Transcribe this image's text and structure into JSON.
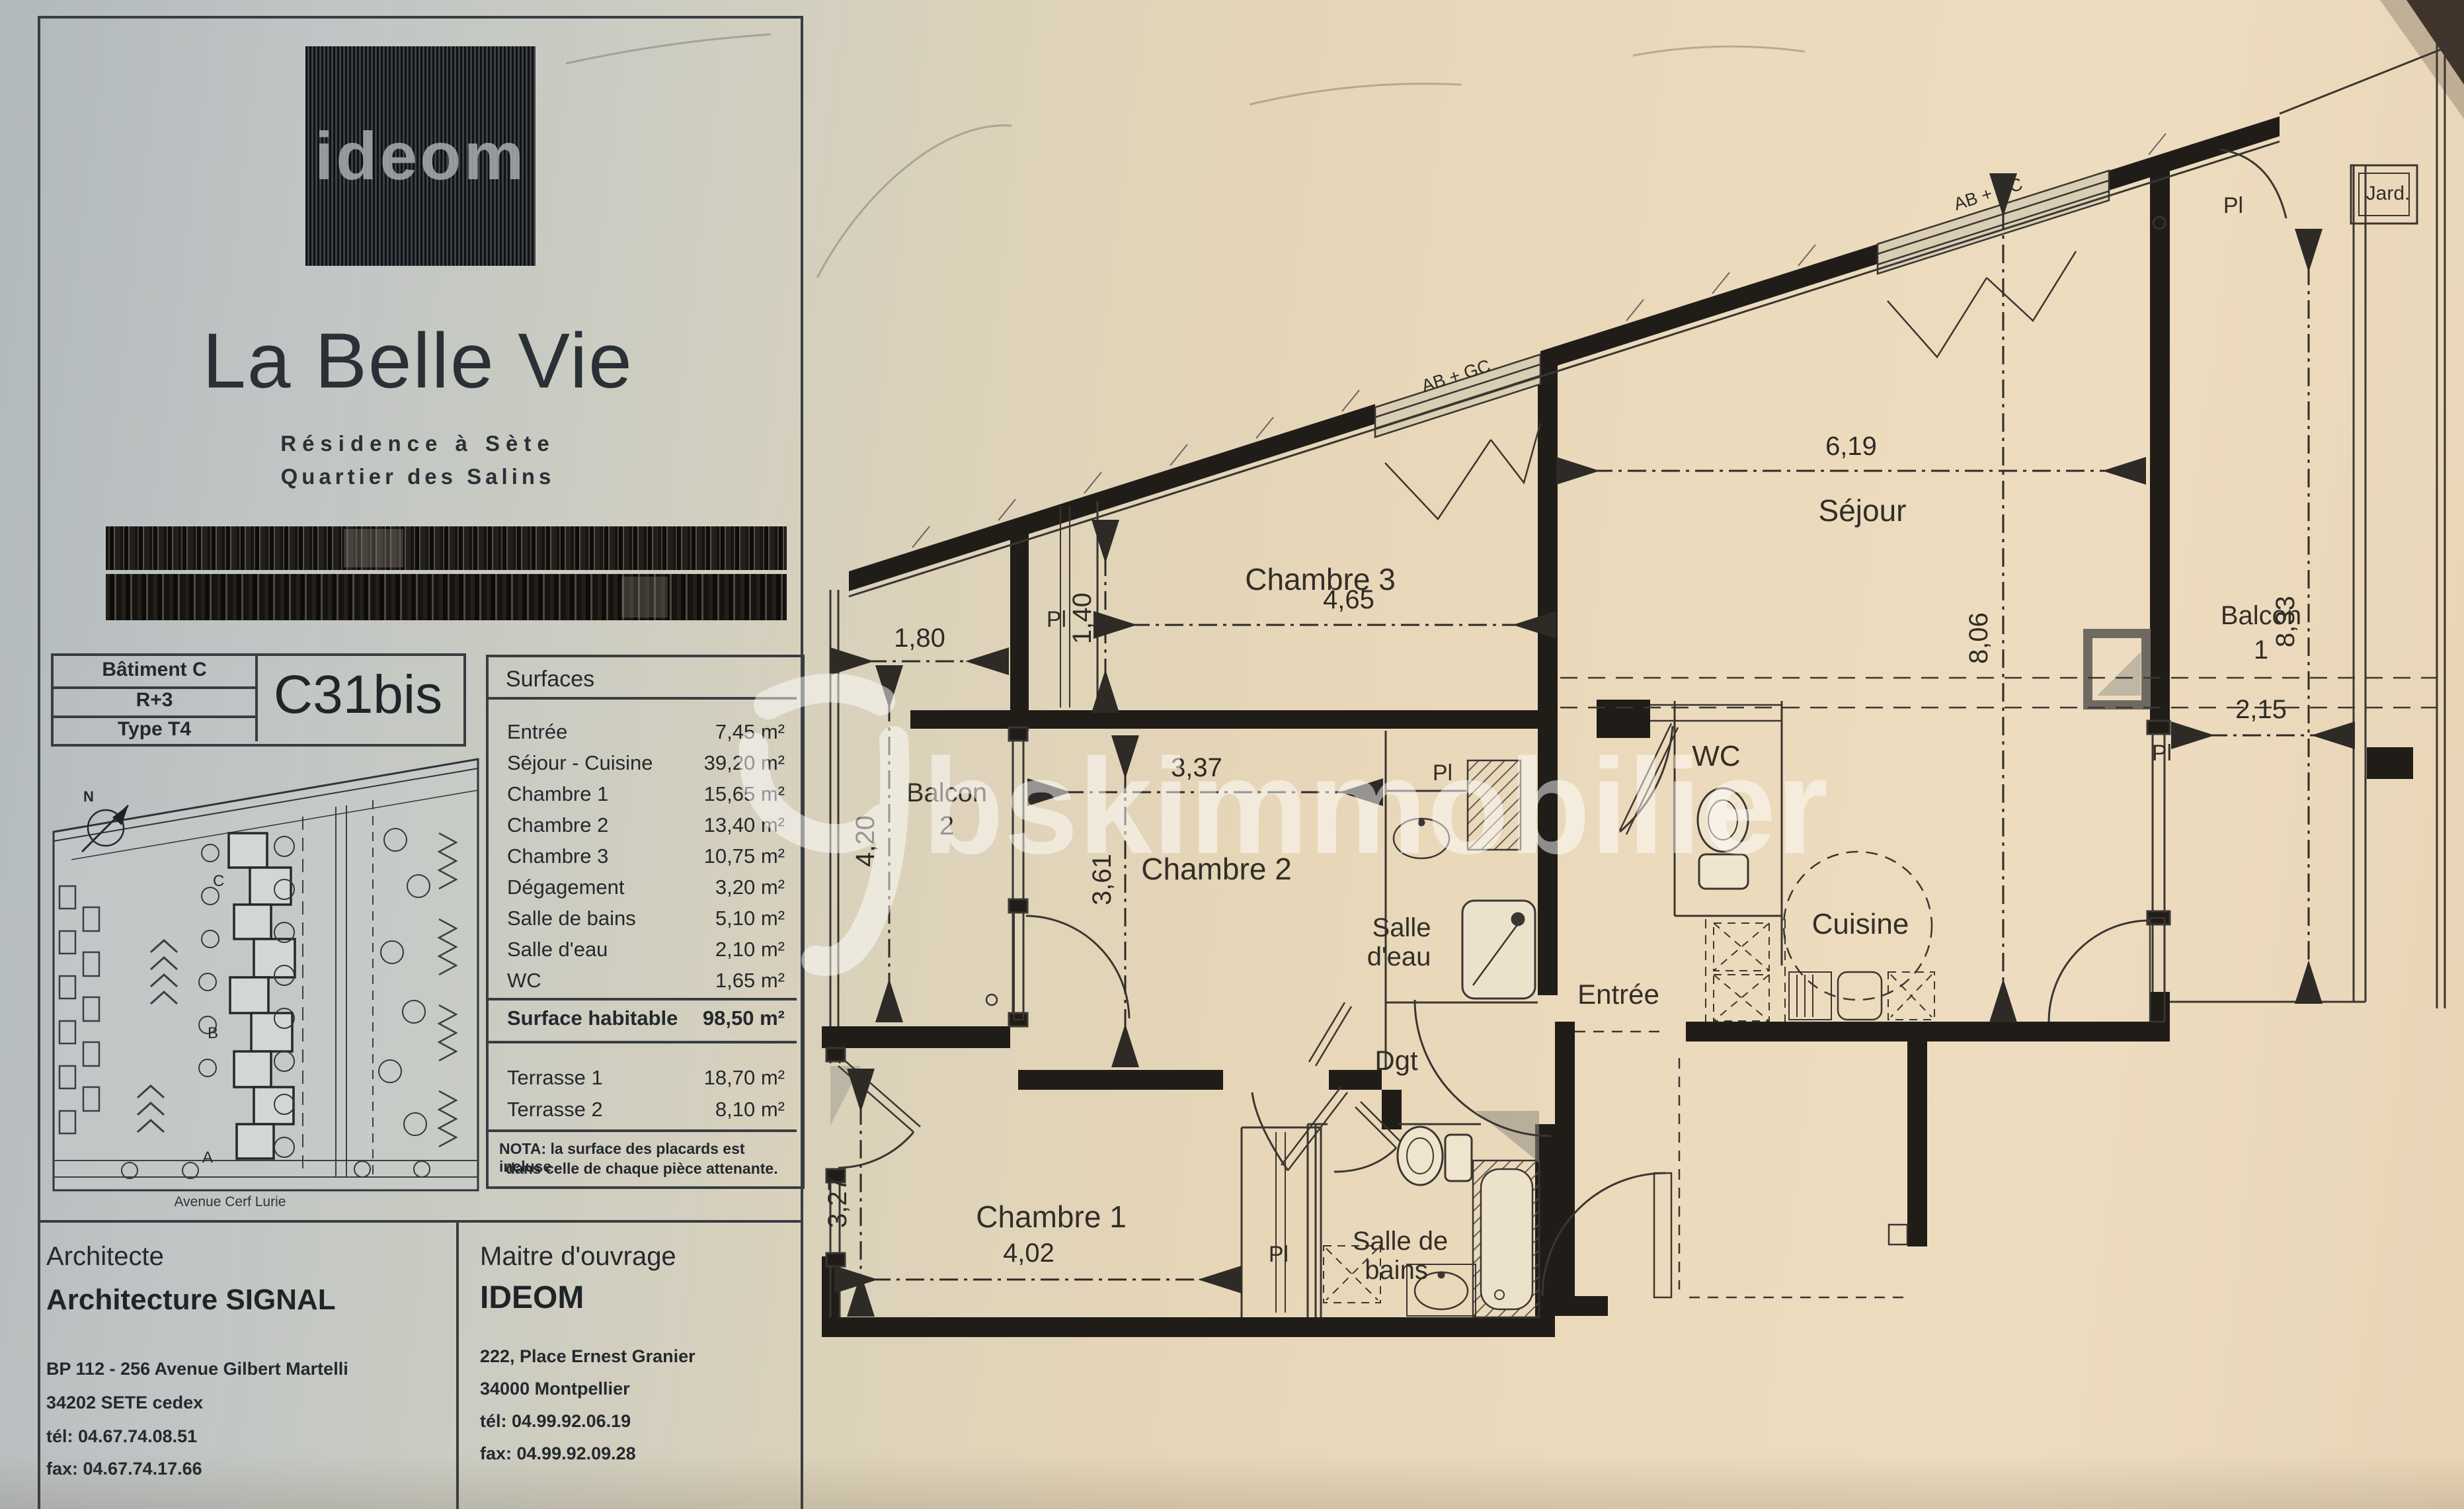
{
  "document": {
    "logo": "ideom",
    "title": "La Belle Vie",
    "subtitle1": "Résidence à Sète",
    "subtitle2": "Quartier des Salins"
  },
  "building": {
    "batiment": "Bâtiment C",
    "etage": "R+3",
    "type": "Type T4",
    "lot": "C31bis"
  },
  "surfaces": {
    "title": "Surfaces",
    "rows": [
      {
        "label": "Entrée",
        "value": "7,45 m²"
      },
      {
        "label": "Séjour - Cuisine",
        "value": "39,20 m²"
      },
      {
        "label": "Chambre 1",
        "value": "15,65 m²"
      },
      {
        "label": "Chambre 2",
        "value": "13,40 m²"
      },
      {
        "label": "Chambre 3",
        "value": "10,75 m²"
      },
      {
        "label": "Dégagement",
        "value": "3,20 m²"
      },
      {
        "label": "Salle de bains",
        "value": "5,10 m²"
      },
      {
        "label": "Salle d'eau",
        "value": "2,10 m²"
      },
      {
        "label": "WC",
        "value": "1,65 m²"
      }
    ],
    "habitable": {
      "label": "Surface habitable",
      "value": "98,50 m²"
    },
    "terraces": [
      {
        "label": "Terrasse 1",
        "value": "18,70 m²"
      },
      {
        "label": "Terrasse 2",
        "value": "8,10 m²"
      }
    ],
    "nota1": "NOTA: la surface des placards est incluse",
    "nota2": "dans celle de chaque pièce attenante."
  },
  "architect": {
    "heading": "Architecte",
    "name": "Architecture SIGNAL",
    "addr1": "BP 112 - 256 Avenue Gilbert Martelli",
    "addr2": "34202 SETE cedex",
    "tel": "tél:  04.67.74.08.51",
    "fax": "fax: 04.67.74.17.66"
  },
  "owner": {
    "heading": "Maitre d'ouvrage",
    "name": "IDEOM",
    "addr1": "222, Place Ernest Granier",
    "addr2": "34000 Montpellier",
    "tel": "tél:  04.99.92.06.19",
    "fax": "fax: 04.99.92.09.28"
  },
  "site_plan": {
    "north": "N",
    "street": "Avenue Cerf Lurie",
    "building_a": "A",
    "building_b": "B",
    "building_c": "C"
  },
  "watermark": {
    "text": "bskimmobilier"
  },
  "plan": {
    "closet_label": "Pl",
    "window_label": "AB + GC",
    "jard": "Jard.",
    "rooms": {
      "chambre3": {
        "label": "Chambre 3"
      },
      "sejour": {
        "label": "Séjour"
      },
      "balcon1": {
        "line1": "Balcon",
        "line2": "1"
      },
      "balcon2": {
        "line1": "Balcon",
        "line2": "2"
      },
      "chambre2": {
        "label": "Chambre 2"
      },
      "salle_eau": {
        "line1": "Salle",
        "line2": "d'eau"
      },
      "wc": {
        "label": "WC"
      },
      "cuisine": {
        "label": "Cuisine"
      },
      "entree": {
        "label": "Entrée"
      },
      "dgt": {
        "label": "Dgt"
      },
      "chambre1": {
        "label": "Chambre 1"
      },
      "salle_bains": {
        "line1": "Salle de",
        "line2": "bains"
      }
    },
    "dims": {
      "d180": "1,80",
      "d140": "1,40",
      "d465": "4,65",
      "d619": "6,19",
      "d806": "8,06",
      "d833": "8,33",
      "d215": "2,15",
      "d420": "4,20",
      "d337": "3,37",
      "d361": "3,61",
      "d327": "3,27",
      "d402": "4,02"
    }
  }
}
